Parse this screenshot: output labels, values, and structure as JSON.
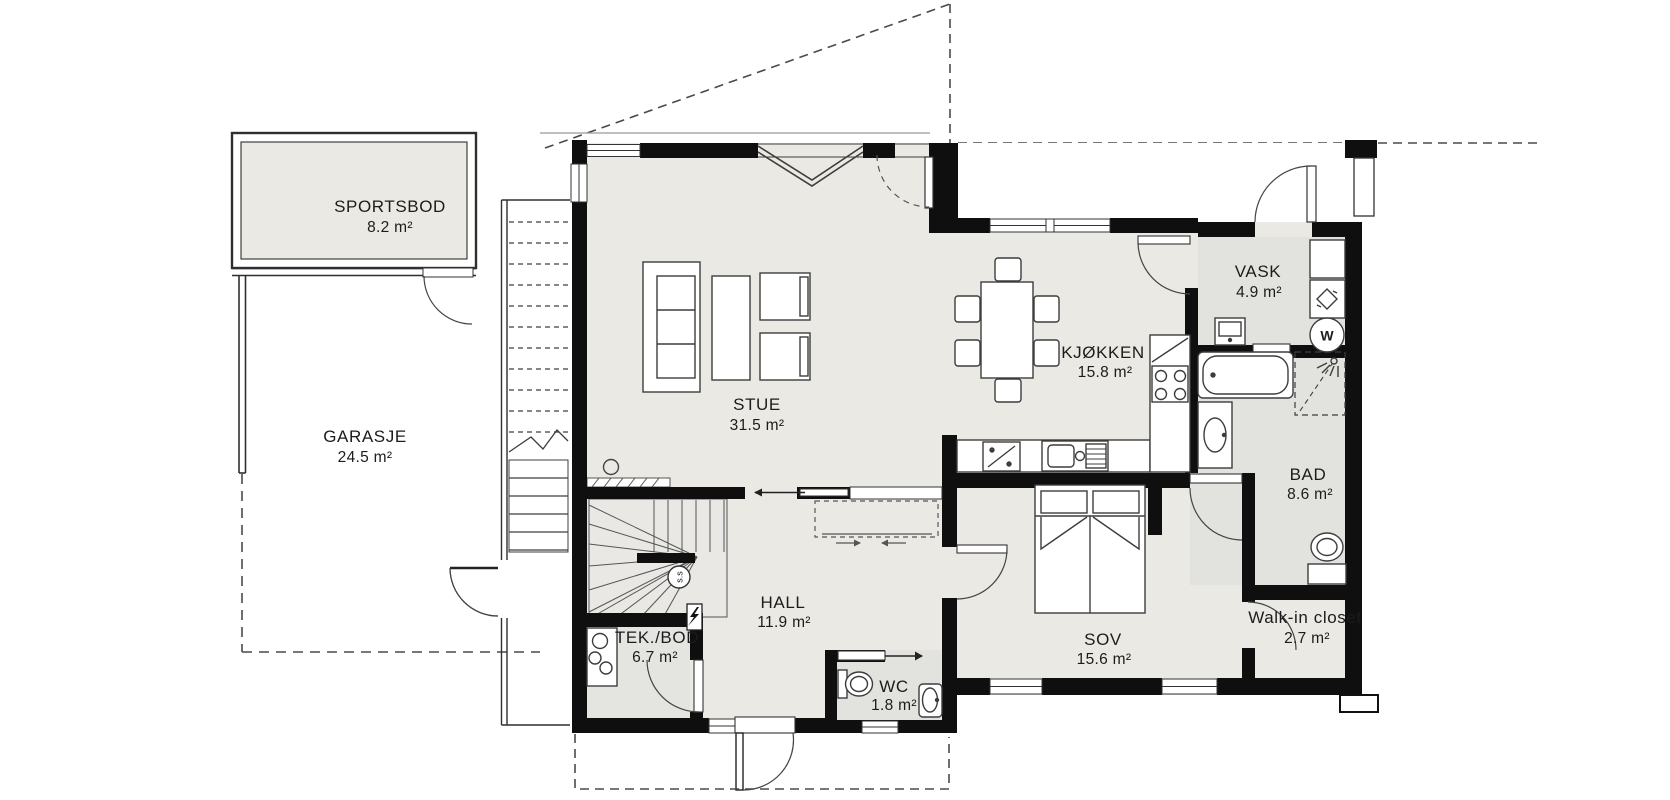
{
  "plan": {
    "rooms": [
      {
        "id": "sportsbod",
        "name": "SPORTSBOD",
        "area": "8.2 m²"
      },
      {
        "id": "garasje",
        "name": "GARASJE",
        "area": "24.5 m²"
      },
      {
        "id": "stue",
        "name": "STUE",
        "area": "31.5 m²"
      },
      {
        "id": "kjokken",
        "name": "KJØKKEN",
        "area": "15.8 m²"
      },
      {
        "id": "vask",
        "name": "VASK",
        "area": "4.9 m²"
      },
      {
        "id": "bad",
        "name": "BAD",
        "area": "8.6 m²"
      },
      {
        "id": "hall",
        "name": "HALL",
        "area": "11.9 m²"
      },
      {
        "id": "tekbod",
        "name": "TEK./BOD",
        "area": "6.7 m²"
      },
      {
        "id": "wc",
        "name": "WC",
        "area": "1.8 m²"
      },
      {
        "id": "sov",
        "name": "SOV",
        "area": "15.6 m²"
      },
      {
        "id": "wic",
        "name": "Walk-in closet",
        "area": "2.7 m²"
      }
    ],
    "annotations": {
      "washer_letter": "W",
      "stair_mark": "s.s"
    },
    "colors": {
      "wall": "#0f0f0f",
      "floor_main": "#eae9e3",
      "floor_wet": "#e2e2df",
      "line": "#3d3d3d",
      "dash": "#4a4a4a",
      "background": "#ffffff"
    }
  }
}
